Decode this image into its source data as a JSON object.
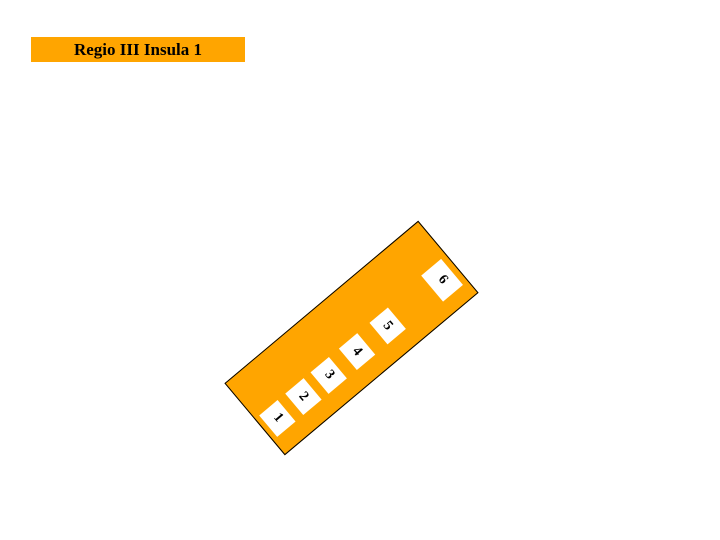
{
  "title_bar": {
    "label": "Regio III Insula 1"
  },
  "insula_block": {
    "name": "Regio III Insula 1",
    "rooms": [
      {
        "label": "1"
      },
      {
        "label": "2"
      },
      {
        "label": "3"
      },
      {
        "label": "4"
      },
      {
        "label": "5"
      },
      {
        "label": "6"
      }
    ]
  },
  "colors": {
    "accent_orange": "#FFA500",
    "outline_black": "#000000",
    "room_white": "#FFFFFF",
    "page_background": "#FFFFFF"
  }
}
